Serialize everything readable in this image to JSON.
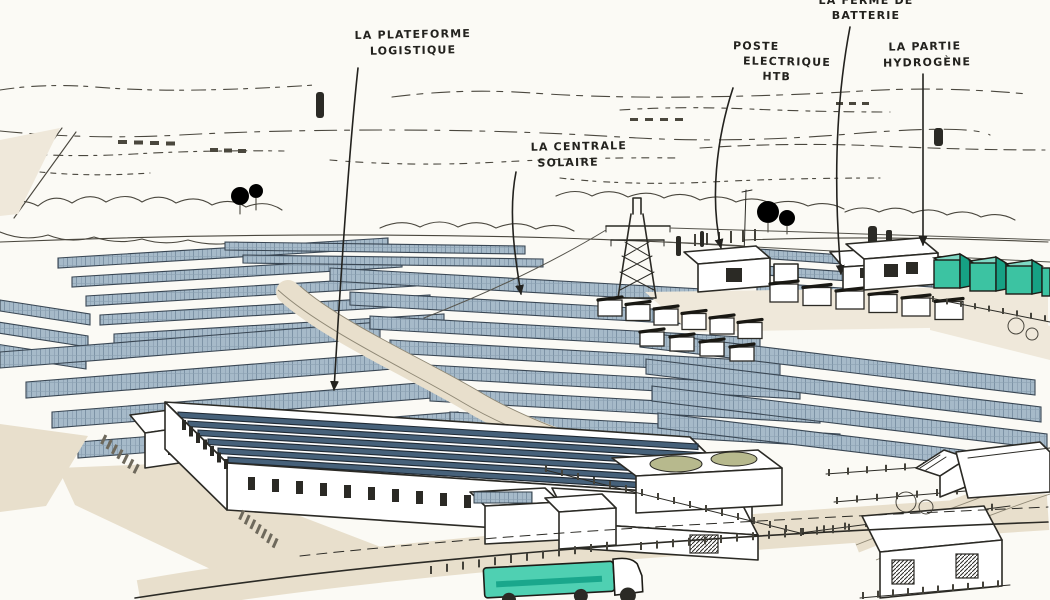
{
  "labels": {
    "plateforme": {
      "line1": "LA PLATEFORME",
      "line2": "LOGISTIQUE"
    },
    "centrale": {
      "line1": "LA CENTRALE",
      "line2": "SOLAIRE"
    },
    "poste": {
      "line1": "POSTE",
      "line2": "ELECTRIQUE",
      "line3": "HTB"
    },
    "batterie": {
      "partial_top_line": "LA FERME DE",
      "line1": "BATTERIE"
    },
    "hydrogene": {
      "line1": "LA PARTIE",
      "line2": "HYDROGÈNE"
    }
  },
  "colors": {
    "paper": "#fbfaf5",
    "ink": "#2b2a25",
    "sketch_ink": "#4a473e",
    "panel_blue": "#a6bac9",
    "panel_grid": "#7d93a6",
    "roof_panel_dark": "#46617a",
    "ground_beige": "#e8dfcc",
    "teal_container": "#3cc3a2",
    "teal_container_dark": "#16a184",
    "truck_teal": "#4fd0b2"
  }
}
